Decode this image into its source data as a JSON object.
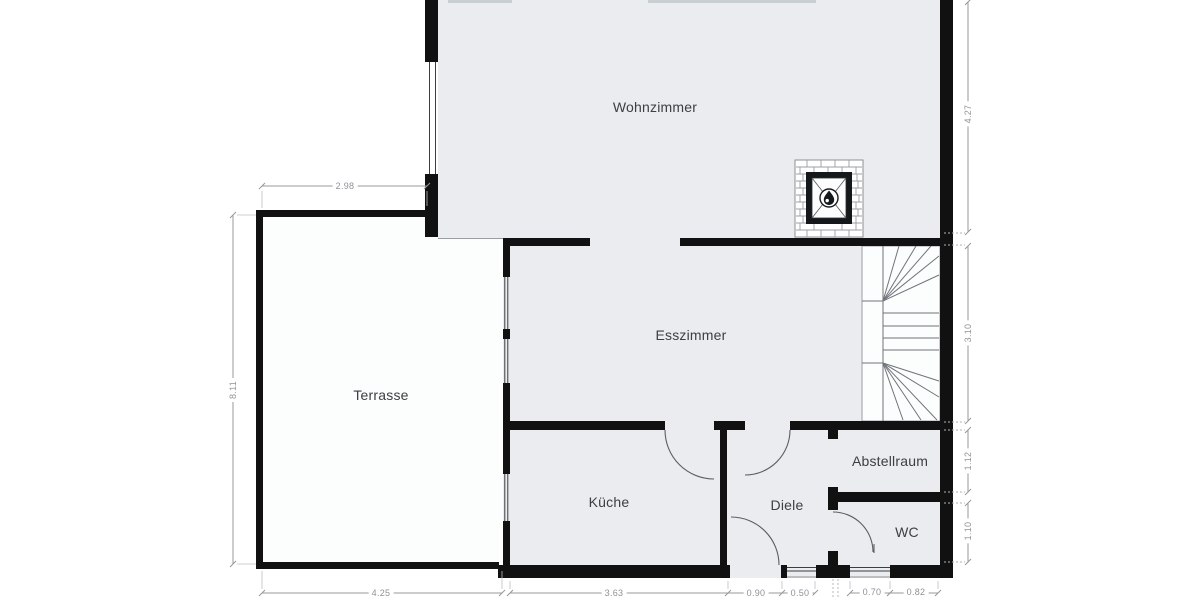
{
  "plan": {
    "rooms": [
      {
        "id": "wohnzimmer",
        "label": "Wohnzimmer"
      },
      {
        "id": "esszimmer",
        "label": "Esszimmer"
      },
      {
        "id": "terrasse",
        "label": "Terrasse"
      },
      {
        "id": "kueche",
        "label": "Küche"
      },
      {
        "id": "diele",
        "label": "Diele"
      },
      {
        "id": "abstellraum",
        "label": "Abstellraum"
      },
      {
        "id": "wc",
        "label": "WC"
      }
    ],
    "dims": [
      {
        "id": "terrasse-width",
        "value": "2.98"
      },
      {
        "id": "terrasse-depth",
        "value": "8.11"
      },
      {
        "id": "right-wohnzimmer",
        "value": "4.27"
      },
      {
        "id": "right-stairs",
        "value": "3.10"
      },
      {
        "id": "right-abstellraum",
        "value": "1.12"
      },
      {
        "id": "right-wc",
        "value": "1.10"
      },
      {
        "id": "bottom-terrasse",
        "value": "4.25"
      },
      {
        "id": "bottom-kueche",
        "value": "3.63"
      },
      {
        "id": "bottom-entry-door",
        "value": "0.90"
      },
      {
        "id": "bottom-window",
        "value": "0.50"
      },
      {
        "id": "bottom-wc-window",
        "value": "0.70"
      },
      {
        "id": "bottom-wall",
        "value": "0.82"
      }
    ],
    "colors": {
      "wall": "#111111",
      "floor": "#eaecef",
      "white_area": "#fcfdfd",
      "dimension": "#95989b",
      "label": "#3c4043"
    }
  }
}
